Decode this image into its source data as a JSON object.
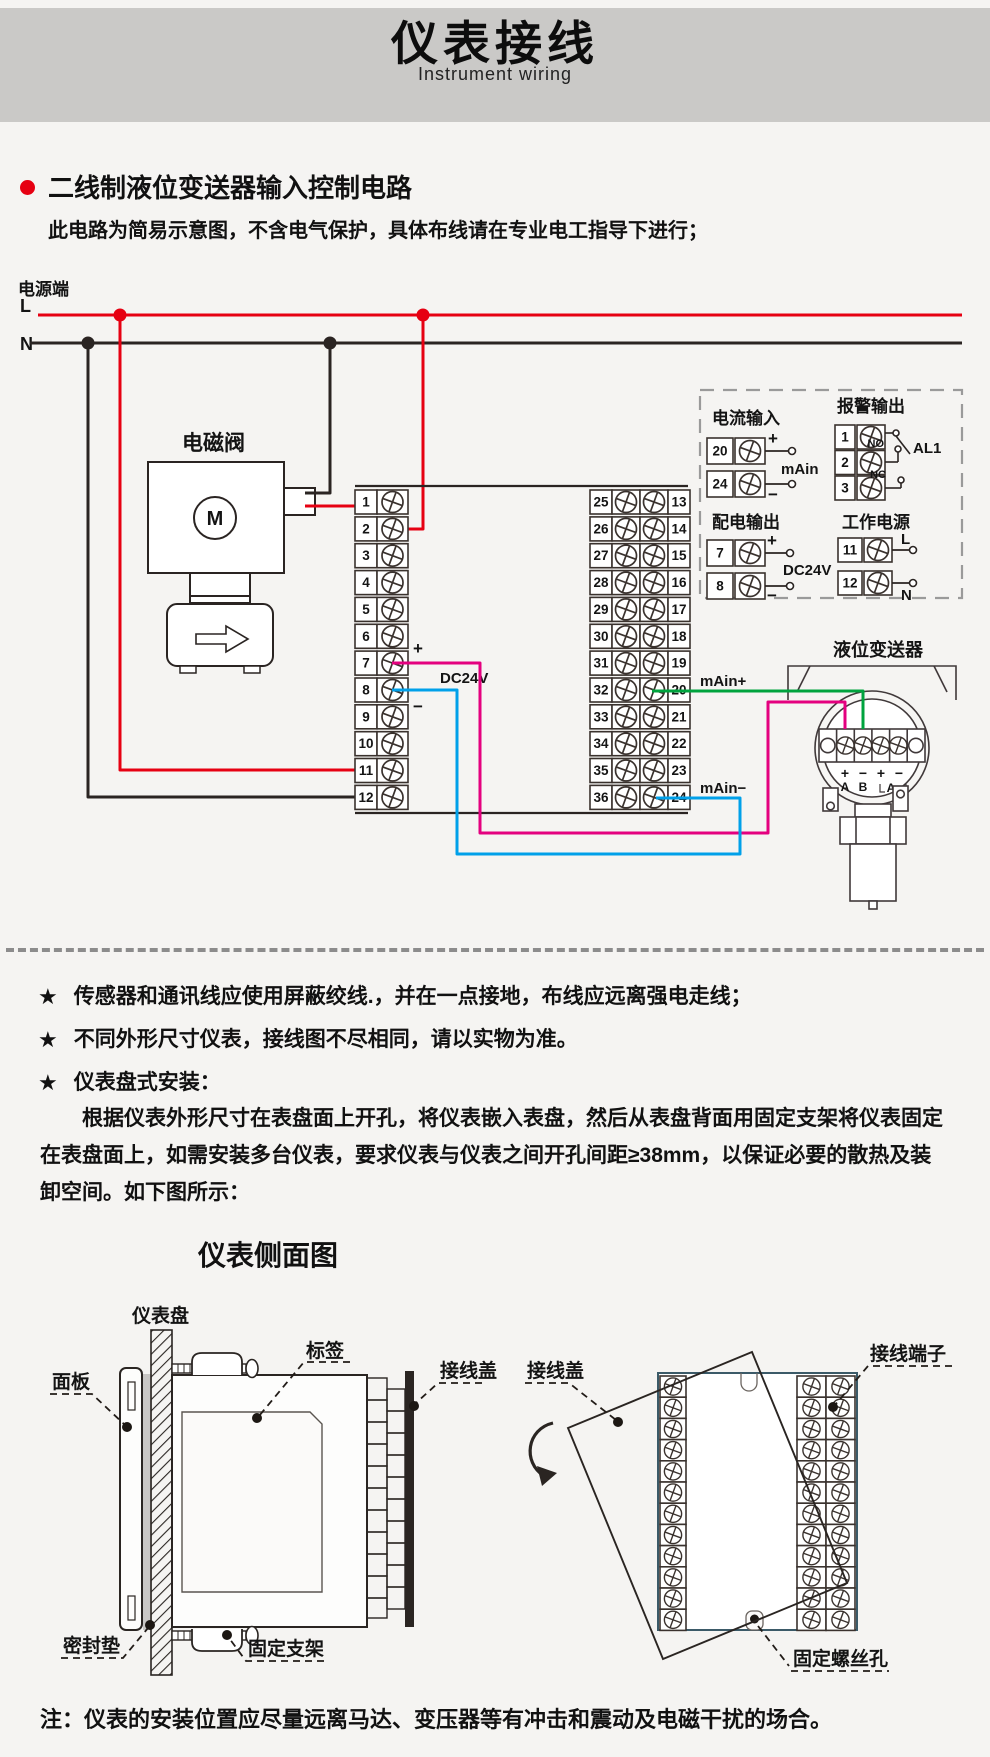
{
  "header": {
    "title": "仪表接线",
    "subtitle": "Instrument wiring"
  },
  "section": {
    "title": "二线制液位变送器输入控制电路",
    "intro": "此电路为简易示意图，不含电气保护，具体布线请在专业电工指导下进行；"
  },
  "wiring": {
    "power_label": "电源端",
    "l": "L",
    "n": "N",
    "solenoid": {
      "label": "电磁阀",
      "motor": "M"
    },
    "left_terminals": [
      "1",
      "2",
      "3",
      "4",
      "5",
      "6",
      "7",
      "8",
      "9",
      "10",
      "11",
      "12"
    ],
    "mid_left_terminals": [
      "25",
      "26",
      "27",
      "28",
      "29",
      "30",
      "31",
      "32",
      "33",
      "34",
      "35",
      "36"
    ],
    "mid_right_terminals": [
      "13",
      "14",
      "15",
      "16",
      "17",
      "18",
      "19",
      "20",
      "21",
      "22",
      "23",
      "24"
    ],
    "plus": "+",
    "minus": "−",
    "dc24v": "DC24V",
    "main_in_plus": "mAin+",
    "main_in_minus": "mAin−",
    "io": {
      "current_input": {
        "title": "电流输入",
        "top": "20",
        "bottom": "24",
        "label": "mAin"
      },
      "alarm_output": {
        "title": "报警输出",
        "t1": "1",
        "t2": "2",
        "t3": "3",
        "no": "NO",
        "nc": "NC",
        "al1": "AL1"
      },
      "dist_output": {
        "title": "配电输出",
        "top": "7",
        "bottom": "8",
        "label": "DC24V"
      },
      "work_power": {
        "title": "工作电源",
        "top": "11",
        "bottom": "12",
        "l": "L",
        "n": "N"
      }
    },
    "transmitter": {
      "label": "液位变送器",
      "p1": "+",
      "p2": "−",
      "p3": "+",
      "p4": "−",
      "a": "A",
      "b": "B",
      "a2": "A"
    }
  },
  "notes": {
    "star": "★",
    "items": [
      "传感器和通讯线应使用屏蔽绞线.，并在一点接地，布线应远离强电走线；",
      "不同外形尺寸仪表，接线图不尽相同，请以实物为准。",
      "仪表盘式安装："
    ],
    "paragraph": "根据仪表外形尺寸在表盘面上开孔，将仪表嵌入表盘，然后从表盘背面用固定支架将仪表固定在表盘面上，如需安装多台仪表，要求仪表与仪表之间开孔间距≥38mm，以保证必要的散热及装卸空间。如下图所示："
  },
  "install": {
    "side_view_title": "仪表侧面图",
    "labels": {
      "panel_board": "仪表盘",
      "front_panel": "面板",
      "tag": "标签",
      "wire_cover_left": "接线盖",
      "wire_cover_right": "接线盖",
      "terminals": "接线端子",
      "gasket": "密封垫",
      "bracket": "固定支架",
      "screw_hole": "固定螺丝孔"
    }
  },
  "footer": {
    "note": "注：仪表的安装位置应尽量远离马达、变压器等有冲击和震动及电磁干扰的场合。"
  },
  "colors": {
    "accent_red": "#e60012",
    "magenta": "#e4007f",
    "blue": "#00a0e9",
    "green": "#00a33e"
  }
}
